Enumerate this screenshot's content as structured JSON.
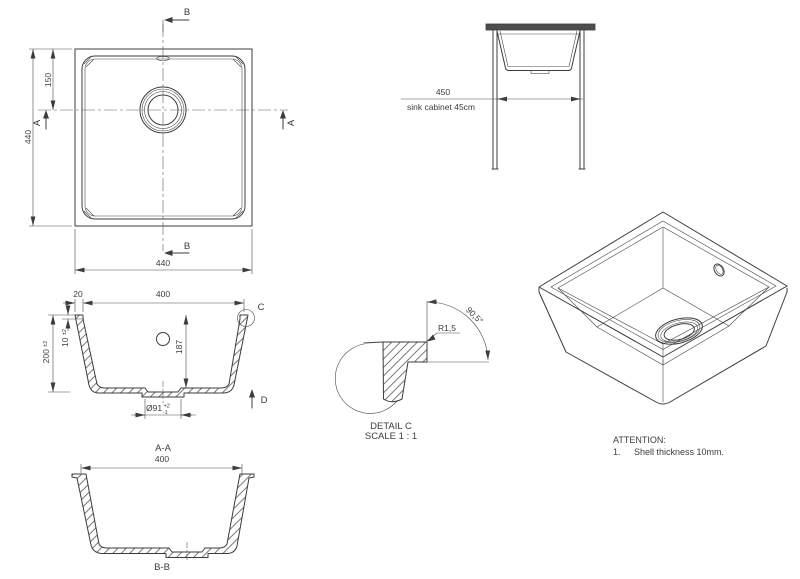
{
  "colors": {
    "line": "#3c3c3c",
    "text": "#3c3c3c",
    "countertop": "#4d4d4d",
    "background": "#ffffff"
  },
  "top_view": {
    "dim_left": "440",
    "dim_bottom": "440",
    "dim_offset": "150",
    "marker_a_left": "A",
    "marker_a_right": "A",
    "marker_b_top": "B",
    "marker_b_bottom": "B"
  },
  "section_aa": {
    "label": "A-A",
    "dim_rim_width": "20",
    "dim_opening": "400",
    "dim_height": "200",
    "dim_height_tol": "±2",
    "dim_rim_height": "10",
    "dim_rim_height_tol": "±2",
    "dim_bowl_depth": "187",
    "dim_drain_dia": "Ø91",
    "dim_drain_tol_upper": "+2",
    "dim_drain_tol_lower": "-1",
    "marker_c": "C",
    "marker_d": "D"
  },
  "section_bb": {
    "label": "B-B",
    "dim_opening": "400"
  },
  "cabinet_view": {
    "dim_width": "450",
    "caption": "sink cabinet 45cm"
  },
  "detail_c": {
    "fillet_radius": "R1,5",
    "wall_angle": "90,5°",
    "title": "DETAIL C",
    "scale": "SCALE 1 : 1"
  },
  "attention": {
    "title": "ATTENTION:",
    "item_no": "1.",
    "item": "Shell thickness 10mm."
  }
}
